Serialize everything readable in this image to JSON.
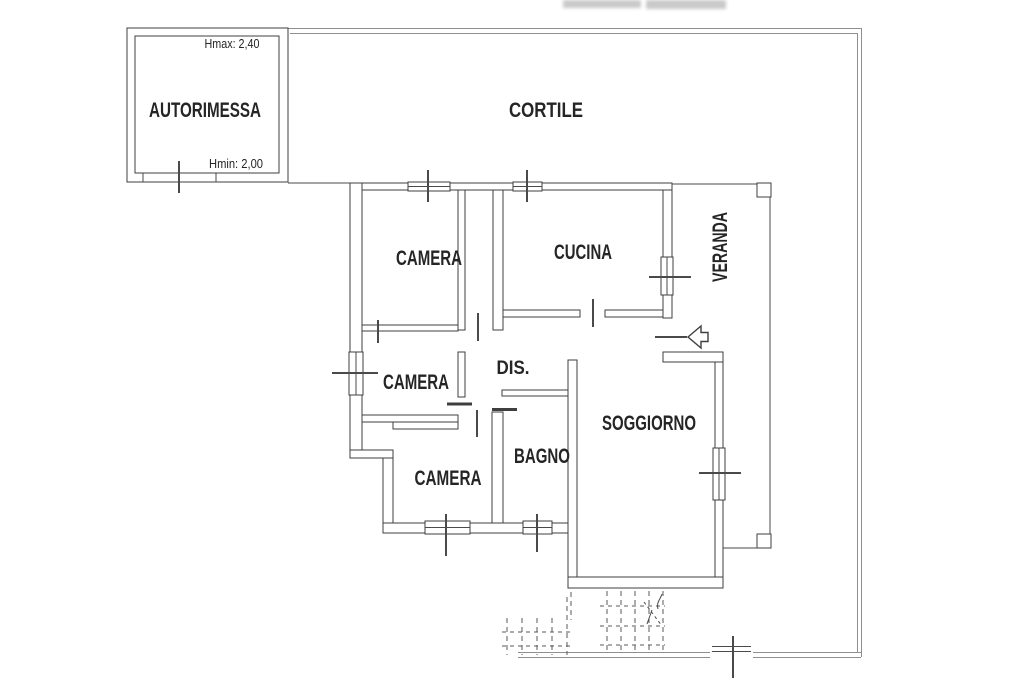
{
  "plan": {
    "courtyard_label": "CORTILE",
    "garage": {
      "label": "AUTORIMESSA",
      "hmax": "Hmax: 2,40",
      "hmin": "Hmin: 2,00"
    },
    "rooms": {
      "bedroom_top_label": "CAMERA",
      "kitchen_label": "CUCINA",
      "veranda_label": "VERANDA",
      "bedroom_middle_label": "CAMERA",
      "hallway_label": "DIS.",
      "living_room_label": "SOGGIORNO",
      "bedroom_bottom_label": "CAMERA",
      "bathroom_label": "BAGNO"
    },
    "icons": {
      "entrance_arrow": "arrow-left-entrance",
      "steps": "dashed-exterior-steps",
      "gate": "bottom-boundary-gate"
    },
    "colors": {
      "walls": "#3f3f3f",
      "boundary": "#8f8f8f",
      "text": "#252525",
      "background": "#ffffff"
    }
  }
}
